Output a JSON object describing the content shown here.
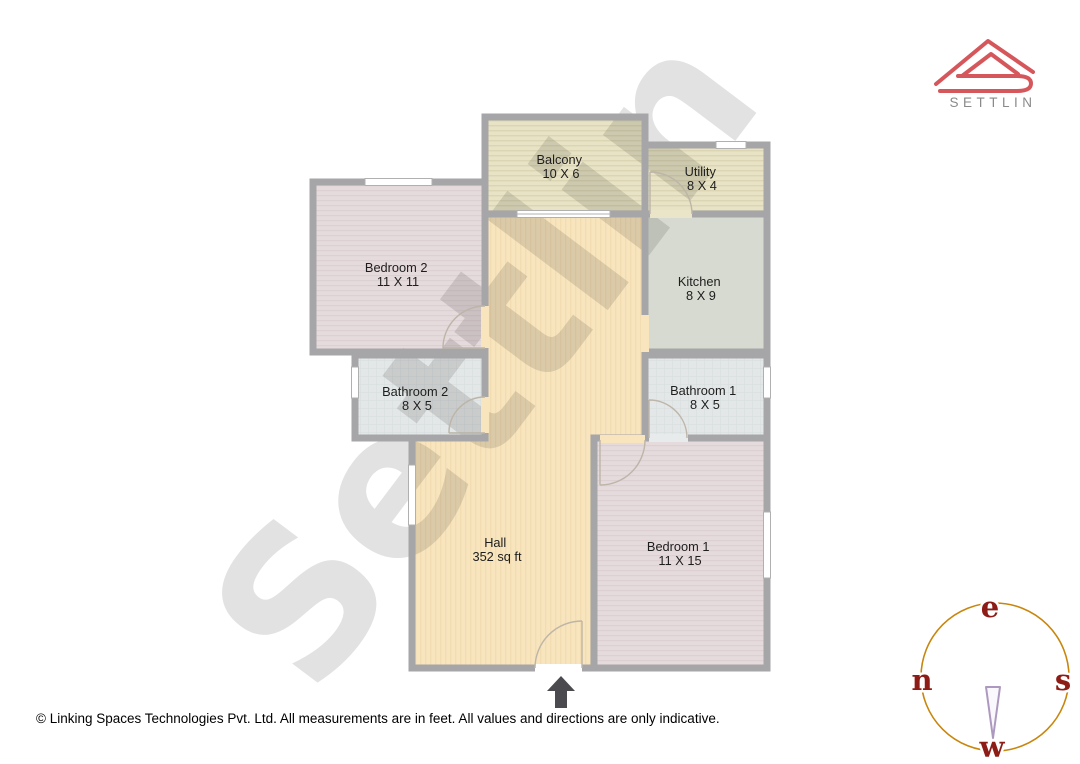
{
  "brand": {
    "name": "SETTLIN",
    "logo_color": "#d5565b",
    "text_color": "#8a8a8a"
  },
  "watermark": {
    "text": "Settlin"
  },
  "floorplan": {
    "rooms": [
      {
        "id": "balcony",
        "name": "Balcony",
        "dims": "10 X 6"
      },
      {
        "id": "utility",
        "name": "Utility",
        "dims": "8 X 4"
      },
      {
        "id": "bedroom2",
        "name": "Bedroom 2",
        "dims": "11 X 11"
      },
      {
        "id": "kitchen",
        "name": "Kitchen",
        "dims": "8 X 9"
      },
      {
        "id": "bathroom2",
        "name": "Bathroom 2",
        "dims": "8 X 5"
      },
      {
        "id": "bathroom1",
        "name": "Bathroom 1",
        "dims": "8 X 5"
      },
      {
        "id": "hall",
        "name": "Hall",
        "dims": "352 sq ft"
      },
      {
        "id": "bedroom1",
        "name": "Bedroom 1",
        "dims": "11 X 15"
      }
    ],
    "colors": {
      "wall": "#a6a6a8",
      "hall_floor": "#f8e4bd",
      "bedroom_floor": "#e5dadc",
      "bathroom_floor": "#e4e7e7",
      "kitchen_floor": "#d7dad0",
      "balcony_floor": "#e8e3c4",
      "entry_arrow": "#4b4b4f"
    }
  },
  "compass": {
    "top": "e",
    "left": "n",
    "right": "s",
    "bottom": "w",
    "circle_color": "#c8860d",
    "letter_color": "#8e1c16"
  },
  "footer": {
    "text": "© Linking Spaces Technologies Pvt. Ltd. All measurements are in feet. All values and directions are only indicative."
  }
}
